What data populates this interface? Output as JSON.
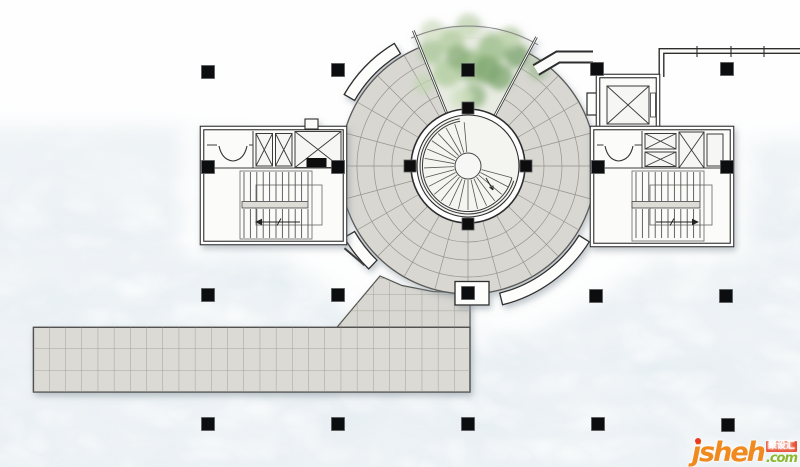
{
  "watermark": {
    "brand": "jsheh",
    "suffix": ".com",
    "badge_text": "聚设汇",
    "brand_color": "#f0891e",
    "suffix_color": "#8bb92e",
    "badge_bg": "#e8472a",
    "badge_text_color": "#ffffff",
    "dot_color": "#e53c23"
  },
  "palette": {
    "water_base": "#f1f5f7",
    "water_shade": "#b8c8d2",
    "paving": "#d8d7d2",
    "paving_line": "#95958d",
    "wall": "#2d2d2d",
    "column": "#0c0d0e",
    "band_fill": "#fdfdfc",
    "court": "#f4f4f1",
    "sector_fill": "#e9ece3"
  },
  "plan": {
    "center": {
      "x": 468,
      "y": 166
    },
    "radii": {
      "annulus_outer": 128,
      "annulus_inner": 57,
      "court": 51,
      "ring_circles": [
        76,
        94,
        111
      ],
      "band_inner": 131,
      "band_outer": 143,
      "foliage_arc": 140,
      "spiral_outer": 45.5,
      "spiral_outer2": 48,
      "hub": 13
    },
    "radial_step": 15,
    "radial_skip": [
      60,
      75,
      90,
      105
    ],
    "sector": {
      "start": 62,
      "end": 112,
      "wall_r2": 146
    },
    "bands": [
      [
        121,
        150
      ],
      [
        210,
        226
      ],
      [
        284,
        328
      ]
    ],
    "treads": {
      "start": 95,
      "end": 320,
      "step": 12.5,
      "r1": 14,
      "r2": 44
    },
    "landing_lines": [
      332.5,
      345
    ],
    "grid_columns": {
      "size": 13,
      "points": [
        [
          208,
          72
        ],
        [
          338,
          70
        ],
        [
          468,
          70
        ],
        [
          597,
          69
        ],
        [
          727,
          69
        ],
        [
          208,
          167
        ],
        [
          338,
          167
        ],
        [
          598,
          167
        ],
        [
          727,
          167
        ],
        [
          208,
          295
        ],
        [
          338,
          295
        ],
        [
          468,
          293
        ],
        [
          596,
          296
        ],
        [
          726,
          296
        ],
        [
          208,
          424
        ],
        [
          338,
          424
        ],
        [
          468,
          424
        ],
        [
          598,
          424
        ],
        [
          728,
          425
        ]
      ]
    },
    "ring_columns": {
      "size": 12,
      "points": [
        [
          468,
          108
        ],
        [
          410,
          166
        ],
        [
          526,
          166
        ],
        [
          468,
          224
        ]
      ]
    },
    "stairs": {
      "left": {
        "x1": 244,
        "x2": 308,
        "step": 6.4,
        "top1": 172,
        "bot1": 201,
        "top2": 209,
        "bot2": 238
      },
      "right": {
        "x1": 636,
        "x2": 700,
        "step": 6.4,
        "top1": 172,
        "bot1": 201,
        "top2": 209,
        "bot2": 238
      }
    },
    "foliage_blobs": [
      {
        "x": 471,
        "y": 66,
        "r": 16,
        "c": "#9cbe8b",
        "o": 0.85
      },
      {
        "x": 500,
        "y": 77,
        "r": 13,
        "c": "#83a974",
        "o": 0.8
      },
      {
        "x": 447,
        "y": 73,
        "r": 14,
        "c": "#b7cfa6",
        "o": 0.9
      },
      {
        "x": 493,
        "y": 49,
        "r": 15,
        "c": "#9cbe8b",
        "o": 0.8
      },
      {
        "x": 451,
        "y": 42,
        "r": 13,
        "c": "#b7cfa6",
        "o": 0.85
      },
      {
        "x": 517,
        "y": 56,
        "r": 12,
        "c": "#6d9a5f",
        "o": 0.7
      },
      {
        "x": 431,
        "y": 52,
        "r": 12,
        "c": "#a9c59a",
        "o": 0.8
      },
      {
        "x": 474,
        "y": 96,
        "r": 12,
        "c": "#8fb27f",
        "o": 0.75
      },
      {
        "x": 462,
        "y": 98,
        "r": 11,
        "c": "#cfe0c0",
        "o": 0.8
      },
      {
        "x": 510,
        "y": 38,
        "r": 11,
        "c": "#bdd3ab",
        "o": 0.8
      },
      {
        "x": 468,
        "y": 26,
        "r": 12,
        "c": "#c9dbb8",
        "o": 0.75
      },
      {
        "x": 432,
        "y": 31,
        "r": 11,
        "c": "#d5e3c6",
        "o": 0.7
      },
      {
        "x": 538,
        "y": 70,
        "r": 10,
        "c": "#93b583",
        "o": 0.6
      },
      {
        "x": 424,
        "y": 84,
        "r": 10,
        "c": "#c2d6b1",
        "o": 0.7
      },
      {
        "x": 487,
        "y": 70,
        "r": 14,
        "c": "#7fa870",
        "o": 0.8
      },
      {
        "x": 458,
        "y": 57,
        "r": 12,
        "c": "#8fb27f",
        "o": 0.8
      }
    ]
  }
}
